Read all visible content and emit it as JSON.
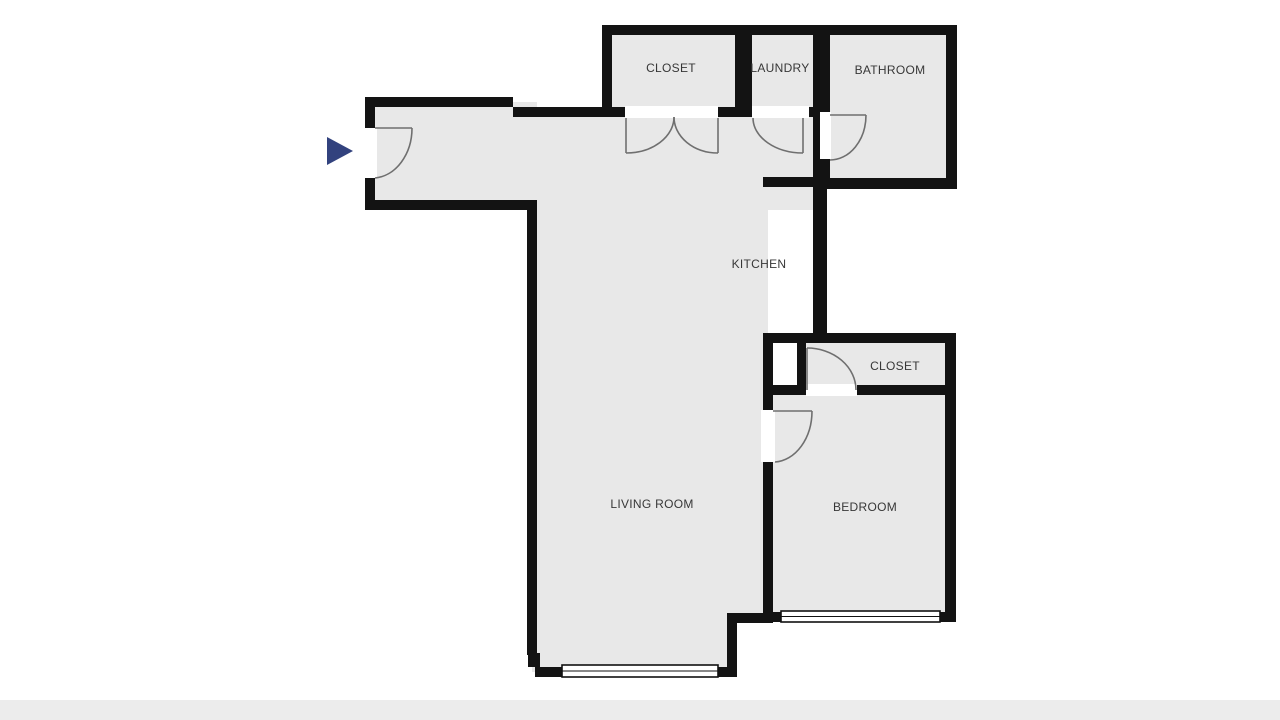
{
  "floorplan": {
    "labels": {
      "closet_top": "CLOSET",
      "laundry": "LAUNDRY",
      "bathroom": "BATHROOM",
      "kitchen": "KITCHEN",
      "closet_bedroom": "CLOSET",
      "living_room": "LIVING ROOM",
      "bedroom": "BEDROOM"
    },
    "colors": {
      "wall": "#131313",
      "floor": "#e8e8e8",
      "door_arc": "#6f6f6f",
      "window_frame": "#111111",
      "entry_arrow": "#32427e",
      "label": "#373737",
      "footer_strip": "#ececec",
      "background": "#ffffff"
    }
  }
}
